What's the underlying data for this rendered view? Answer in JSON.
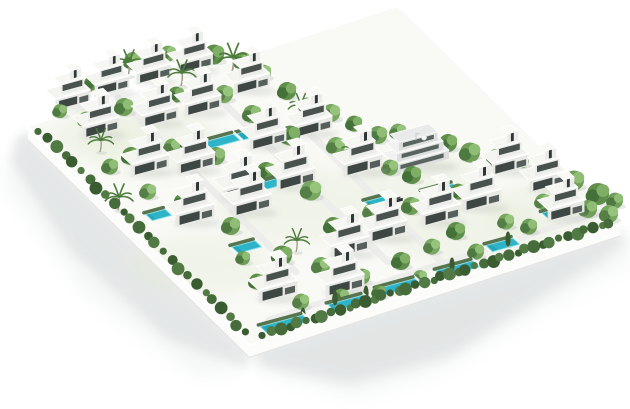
{
  "canvas": {
    "width": 630,
    "height": 409,
    "background": "#ffffff"
  },
  "scene_type": "villa-community-3d-render",
  "colors": {
    "ground": "#f9f9f6",
    "wash": "#e3ebd4",
    "road": "#ededeb",
    "wall_face": "#fcfcfb",
    "wall_top": "#ffffff",
    "wall_base": "#e4e5e3",
    "shadow_near": "#dfe2e2",
    "shadow_far": "#eef0f0",
    "villa_front": "#e8e9e5",
    "villa_front_upper": "#ecedea",
    "villa_side": "#f3f3f0",
    "villa_roof": "#f4f5f1",
    "villa_roof_upper": "#f6f7f3",
    "villa_roof_box": "#f9faf6",
    "glass_dark": "#3e4744",
    "glass_mid": "#49524e",
    "glass_deep": "#2f3734",
    "garage": "#565f5b",
    "parapet": "#ffffff",
    "club_front": "#dcdfdd",
    "club_band": "#f2f3f1",
    "club_glass": "#5a6360",
    "club_roof": "#e8ebe9",
    "pool_water": "#2eb4c8",
    "pool_deep": "#1f9fb3",
    "pool_rim": "#8fe2ec",
    "pool_deck": "#f7f8f6",
    "pool_hedge": "#47663c",
    "tree_shadow": "#b9c0ba",
    "trunk": "#a39a88",
    "palm_leaf": "#4c7c3c",
    "cypress": "#3b5c31",
    "car_body": "#2e3335",
    "car_roof": "#474d4f",
    "tree_tones": [
      [
        "#6f9e58",
        "#4e7941",
        "#90bd75"
      ],
      [
        "#5f8e4b",
        "#44703a",
        "#7fae65"
      ],
      [
        "#77a761",
        "#557f46",
        "#97c47c"
      ]
    ],
    "hedge_tones": [
      "#466c3b",
      "#3a5c31",
      "#527a44"
    ]
  },
  "axes": {
    "u": [
      0.965,
      -0.262
    ],
    "back": [
      -0.733,
      -0.68
    ]
  },
  "site": {
    "polygon": [
      [
        28,
        127
      ],
      [
        398,
        7
      ],
      [
        620,
        225
      ],
      [
        250,
        345
      ]
    ]
  },
  "walls": {
    "left": {
      "face": [
        [
          28,
          127
        ],
        [
          250,
          345
        ],
        [
          250,
          358
        ],
        [
          28,
          140
        ]
      ]
    },
    "bottom": {
      "face": [
        [
          250,
          345
        ],
        [
          620,
          225
        ],
        [
          620,
          236
        ],
        [
          250,
          357
        ]
      ]
    }
  },
  "shadows": [
    {
      "points": [
        [
          18,
          142
        ],
        [
          242,
          372
        ],
        [
          196,
          376
        ],
        [
          84,
          292
        ],
        [
          2,
          182
        ]
      ],
      "color": "#eef0f0",
      "opacity": 0.6,
      "blur": 9
    },
    {
      "points": [
        [
          28,
          131
        ],
        [
          250,
          349
        ],
        [
          247,
          369
        ],
        [
          168,
          339
        ],
        [
          70,
          250
        ],
        [
          12,
          162
        ],
        [
          16,
          138
        ]
      ],
      "color": "#dfe2e2",
      "opacity": 0.75,
      "blur": 5
    },
    {
      "points": [
        [
          248,
          352
        ],
        [
          630,
          236
        ],
        [
          630,
          262
        ],
        [
          536,
          314
        ],
        [
          436,
          372
        ],
        [
          356,
          396
        ],
        [
          266,
          372
        ]
      ],
      "color": "#eef0f0",
      "opacity": 0.6,
      "blur": 10
    },
    {
      "points": [
        [
          250,
          350
        ],
        [
          620,
          230
        ],
        [
          626,
          244
        ],
        [
          556,
          288
        ],
        [
          450,
          356
        ],
        [
          350,
          384
        ],
        [
          262,
          366
        ]
      ],
      "color": "#dfe2e2",
      "opacity": 0.8,
      "blur": 6
    }
  ],
  "washes": [
    [
      150,
      140,
      70,
      32
    ],
    [
      300,
      205,
      85,
      38
    ],
    [
      460,
      230,
      80,
      32
    ],
    [
      200,
      265,
      70,
      30
    ],
    [
      540,
      210,
      55,
      26
    ],
    [
      95,
      135,
      45,
      22
    ],
    [
      420,
      175,
      60,
      26
    ]
  ],
  "roads": [
    {
      "from": [
        118,
        98
      ],
      "to": [
        296,
        272
      ],
      "w": 7
    },
    {
      "from": [
        206,
        86
      ],
      "to": [
        388,
        262
      ],
      "w": 7
    },
    {
      "from": [
        296,
        120
      ],
      "to": [
        452,
        272
      ],
      "w": 7
    },
    {
      "from": [
        268,
        320
      ],
      "to": [
        600,
        212
      ],
      "w": 6
    },
    {
      "from": [
        44,
        146
      ],
      "to": [
        244,
        342
      ],
      "w": 6
    }
  ],
  "villas": [
    [
      73,
      106,
      0.9
    ],
    [
      112,
      92,
      0.9
    ],
    [
      154,
      80,
      0.9
    ],
    [
      195,
      70,
      0.92
    ],
    [
      252,
      90,
      0.92
    ],
    [
      101,
      134,
      0.95
    ],
    [
      160,
      123,
      0.95
    ],
    [
      203,
      112,
      0.95
    ],
    [
      268,
      146,
      0.95
    ],
    [
      314,
      133,
      0.95
    ],
    [
      150,
      172,
      0.98
    ],
    [
      196,
      170,
      0.98
    ],
    [
      243,
      197,
      1
    ],
    [
      296,
      186,
      1
    ],
    [
      363,
      172,
      1
    ],
    [
      510,
      171,
      0.95
    ],
    [
      548,
      188,
      0.95
    ],
    [
      195,
      222,
      1
    ],
    [
      252,
      212,
      1
    ],
    [
      350,
      254,
      1
    ],
    [
      388,
      238,
      1
    ],
    [
      441,
      222,
      1
    ],
    [
      482,
      207,
      1
    ],
    [
      566,
      217,
      0.95
    ],
    [
      278,
      298,
      1
    ],
    [
      345,
      292,
      1
    ]
  ],
  "clubhouse": {
    "x": 422,
    "y": 166,
    "s": 1
  },
  "pools": [
    [
      215,
      147,
      52
    ],
    [
      258,
      136,
      30
    ],
    [
      275,
      187,
      30
    ],
    [
      162,
      218,
      20
    ],
    [
      250,
      250,
      24
    ],
    [
      288,
      327,
      44
    ],
    [
      352,
      306,
      36
    ],
    [
      402,
      290,
      40
    ],
    [
      461,
      272,
      38
    ],
    [
      506,
      248,
      28
    ],
    [
      444,
      194,
      32
    ],
    [
      382,
      205,
      22
    ],
    [
      568,
      214,
      40
    ]
  ],
  "trees": [
    [
      60,
      115,
      7,
      0
    ],
    [
      92,
      88,
      8,
      1
    ],
    [
      133,
      66,
      9,
      0
    ],
    [
      168,
      58,
      8,
      2
    ],
    [
      214,
      60,
      10,
      1
    ],
    [
      243,
      66,
      9,
      0
    ],
    [
      263,
      77,
      8,
      2
    ],
    [
      287,
      96,
      9,
      1
    ],
    [
      307,
      110,
      8,
      0
    ],
    [
      331,
      118,
      9,
      2
    ],
    [
      354,
      128,
      8,
      1
    ],
    [
      378,
      140,
      9,
      0
    ],
    [
      398,
      136,
      8,
      2
    ],
    [
      448,
      148,
      9,
      1
    ],
    [
      470,
      158,
      10,
      0
    ],
    [
      496,
      163,
      9,
      2
    ],
    [
      522,
      165,
      7,
      1
    ],
    [
      86,
      124,
      8,
      2
    ],
    [
      124,
      112,
      9,
      0
    ],
    [
      176,
      99,
      8,
      1
    ],
    [
      224,
      99,
      9,
      2
    ],
    [
      252,
      119,
      9,
      0
    ],
    [
      290,
      141,
      10,
      1
    ],
    [
      336,
      151,
      9,
      2
    ],
    [
      361,
      151,
      8,
      0
    ],
    [
      412,
      180,
      9,
      1
    ],
    [
      390,
      172,
      8,
      2
    ],
    [
      436,
      152,
      8,
      0
    ],
    [
      458,
      196,
      8,
      1
    ],
    [
      574,
      186,
      10,
      0
    ],
    [
      598,
      200,
      11,
      1
    ],
    [
      609,
      219,
      9,
      2
    ],
    [
      588,
      214,
      9,
      0
    ],
    [
      561,
      201,
      8,
      1
    ],
    [
      543,
      206,
      8,
      2
    ],
    [
      615,
      205,
      8,
      0
    ],
    [
      131,
      161,
      9,
      1
    ],
    [
      172,
      151,
      8,
      2
    ],
    [
      216,
      161,
      9,
      0
    ],
    [
      266,
      176,
      9,
      1
    ],
    [
      311,
      196,
      10,
      2
    ],
    [
      231,
      231,
      9,
      0
    ],
    [
      182,
      206,
      8,
      1
    ],
    [
      148,
      196,
      8,
      2
    ],
    [
      110,
      171,
      8,
      0
    ],
    [
      333,
      231,
      9,
      1
    ],
    [
      371,
      216,
      8,
      2
    ],
    [
      411,
      211,
      9,
      0
    ],
    [
      456,
      236,
      9,
      1
    ],
    [
      506,
      226,
      8,
      2
    ],
    [
      529,
      231,
      8,
      0
    ],
    [
      282,
      261,
      10,
      1
    ],
    [
      321,
      271,
      9,
      2
    ],
    [
      362,
      281,
      8,
      0
    ],
    [
      401,
      266,
      9,
      1
    ],
    [
      432,
      251,
      8,
      2
    ],
    [
      476,
      256,
      8,
      0
    ],
    [
      257,
      286,
      8,
      1
    ],
    [
      301,
      306,
      8,
      2
    ],
    [
      341,
      301,
      8,
      0
    ],
    [
      379,
      296,
      7,
      1
    ],
    [
      420,
      281,
      7,
      2
    ],
    [
      243,
      262,
      7,
      0
    ]
  ],
  "palms": [
    [
      128,
      76,
      1
    ],
    [
      181,
      86,
      1
    ],
    [
      232,
      72,
      1.1
    ],
    [
      300,
      117,
      0.9
    ],
    [
      100,
      152,
      0.9
    ],
    [
      118,
      210,
      1
    ],
    [
      352,
      162,
      0.9
    ],
    [
      296,
      252,
      0.9
    ]
  ],
  "cypresses": [
    [
      335,
      305
    ],
    [
      303,
      322
    ],
    [
      452,
      272
    ],
    [
      508,
      246
    ],
    [
      366,
      300
    ]
  ],
  "hedges": [
    {
      "from": [
        40,
        134
      ],
      "to": [
        246,
        336
      ],
      "count": 26
    },
    {
      "from": [
        264,
        338
      ],
      "to": [
        610,
        226
      ],
      "count": 42
    }
  ],
  "car": {
    "x": 398,
    "y": 202
  }
}
